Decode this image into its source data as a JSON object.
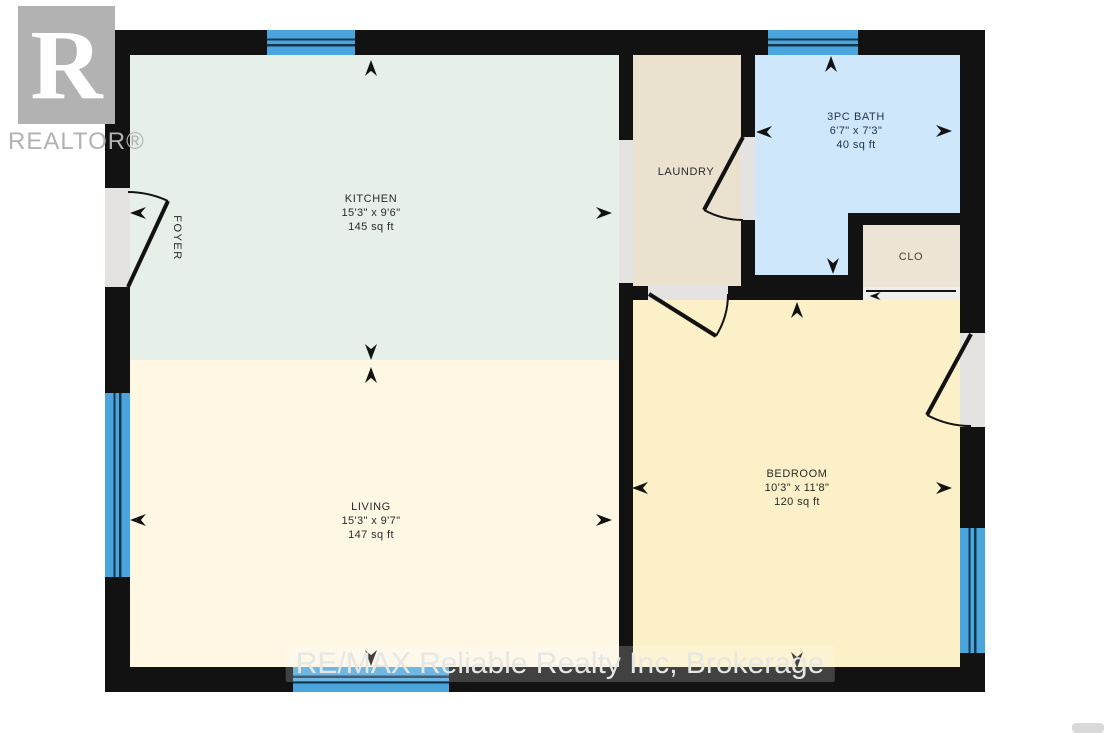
{
  "branding": {
    "logo_letter": "R",
    "logo_text": "REALTOR®",
    "watermark": "RE/MAX Reliable Realty Inc, Brokerage"
  },
  "rooms": {
    "kitchen": {
      "name": "KITCHEN",
      "dimensions": "15'3\" x 9'6\"",
      "area": "145 sq ft"
    },
    "living": {
      "name": "LIVING",
      "dimensions": "15'3\" x 9'7\"",
      "area": "147 sq ft"
    },
    "laundry": {
      "name": "LAUNDRY"
    },
    "bath": {
      "name": "3PC BATH",
      "dimensions": "6'7\" x 7'3\"",
      "area": "40 sq ft"
    },
    "closet": {
      "name": "CLO"
    },
    "bedroom": {
      "name": "BEDROOM",
      "dimensions": "10'3\" x 11'8\"",
      "area": "120 sq ft"
    },
    "foyer": {
      "name": "FOYER"
    }
  },
  "colors": {
    "wall": "#121212",
    "kitchen_floor": "#e7efe9",
    "living_floor": "#fdf7e4",
    "laundry_floor": "#eae1cf",
    "bath_floor": "#cfe7fa",
    "closet_floor": "#ece4d4",
    "bedroom_floor": "#fbf0c7",
    "window": "#4aa5dc",
    "window_line": "#14364f",
    "opening": "#e4e3e1",
    "logo_gray": "#b2b2b2",
    "watermark": "#e6e6e3"
  }
}
